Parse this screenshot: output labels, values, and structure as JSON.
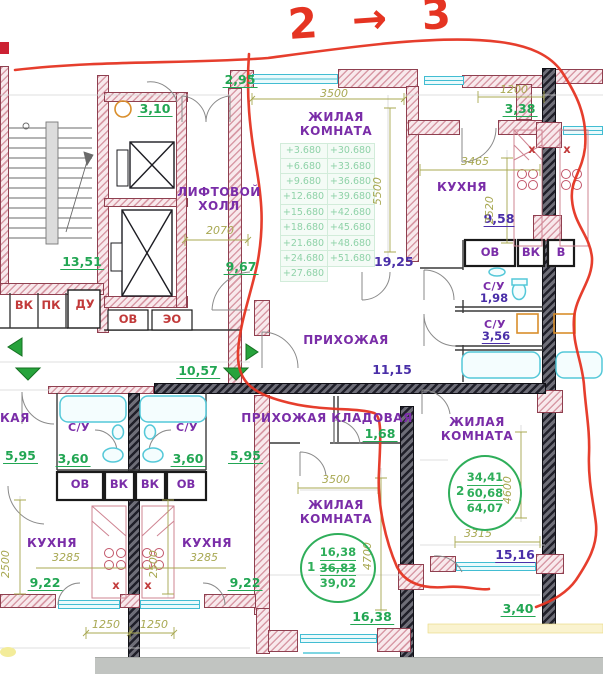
{
  "annotation": {
    "note": "2 → 3"
  },
  "rooms": {
    "living_top": "ЖИЛАЯ КОМНАТА",
    "lift_hall": "ЛИФТОВОЙ ХОЛЛ",
    "kitchen_top": "КУХНЯ",
    "hall_upper": "ПРИХОЖАЯ",
    "hall_lower": "ПРИХОЖАЯ",
    "storage": "КЛАДОВАЯ",
    "wc_r1": "С/У",
    "wc_r2": "С/У",
    "wc_l1": "С/У",
    "wc_l2": "С/У",
    "living_bc": "ЖИЛАЯ КОМНАТА",
    "living_br": "ЖИЛАЯ КОМНАТА",
    "kitchen_bl1": "КУХНЯ",
    "kitchen_bl2": "КУХНЯ",
    "partial_left": "КАЯ"
  },
  "areas": {
    "a_295": "2,95",
    "a_310": "3,10",
    "a_338": "3,38",
    "a_958": "9,58",
    "a_198": "1,98",
    "a_356": "3,56",
    "a_967": "9,67",
    "a_1351": "13,51",
    "a_1925": "19,25",
    "a_1115": "11,15",
    "a_1057": "10,57",
    "a_168": "1,68",
    "a_595a": "5,95",
    "a_595b": "5,95",
    "a_360a": "3,60",
    "a_360b": "3,60",
    "a_922a": "9,22",
    "a_922b": "9,22",
    "a_1638": "16,38",
    "a_1516": "15,16",
    "a_340": "3,40"
  },
  "dims": {
    "d3500a": "3500",
    "d5500": "5500",
    "d1200": "1200",
    "d3465": "3465",
    "d2520": "2520",
    "d2070": "2070",
    "d3315": "3315",
    "d4600": "4600",
    "d4700": "4700",
    "d3500b": "3500",
    "d2500a": "2500",
    "d2500b": "2500",
    "d3285a": "3285",
    "d3285b": "3285",
    "d1250a": "1250",
    "d1250b": "1250"
  },
  "stamps": {
    "apt1": {
      "no": "1",
      "v1": "16,38",
      "v2": "36,83",
      "v3": "39,02"
    },
    "apt2": {
      "no": "2",
      "v1": "34,41",
      "v2": "60,68",
      "v3": "64,07"
    }
  },
  "elev": {
    "c1": [
      "+3.680",
      "+6.680",
      "+9.680",
      "+12.680",
      "+15.680",
      "+18.680",
      "+21.680",
      "+24.680",
      "+27.680"
    ],
    "c2": [
      "+30.680",
      "+33.680",
      "+36.680",
      "+39.680",
      "+42.680",
      "+45.680",
      "+48.680",
      "+51.680"
    ]
  },
  "eng": {
    "vk_red": "ВК",
    "pk_red": "ПК",
    "du_red": "ДУ",
    "ov_red": "ОВ",
    "eo_red": "ЭО",
    "ov1": "ОВ",
    "vk1": "ВК",
    "vk2": "ВК",
    "ov2": "ОВ",
    "ov3": "ОВ",
    "vk3": "ВК",
    "v3": "В",
    "x1": "х",
    "x2": "х",
    "x3": "х",
    "x4": "х"
  },
  "colors": {
    "wall_pink": "#d89aa6",
    "wall_dark": "#20202a",
    "window_teal": "#42bdd2",
    "room_purple": "#7a2da8",
    "area_green": "#22a653",
    "dim_olive": "#a8a852",
    "red_marker": "#e53422",
    "stamp_green": "#2fae5a"
  }
}
